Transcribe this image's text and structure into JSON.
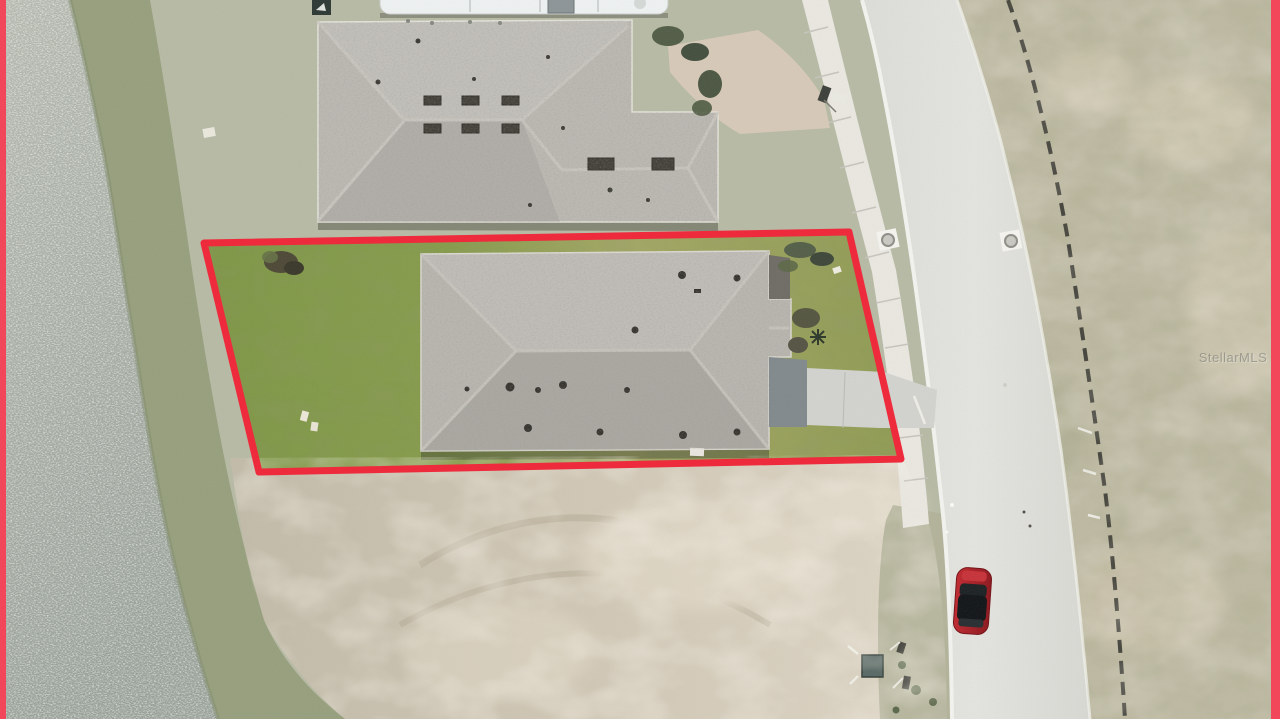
{
  "image": {
    "kind": "aerial-drone-photograph",
    "watermark": "StellarMLS"
  },
  "scene": {
    "water": "pond",
    "bank": "grassy shoreline bank",
    "neighbor_house": "neighboring house roof (top)",
    "rv": "white RV parked at top edge",
    "gravel_drive": "gravel driveway",
    "subject_lot": "red-outlined subject property",
    "subject_house": "subject house gray shingle roof",
    "driveway": "concrete driveway to street",
    "sidewalk": "concrete sidewalk",
    "road": "curved concrete street",
    "silt_fence": "construction silt fence",
    "vacant_lot": "graded dirt vacant lot",
    "car": "red car on road",
    "utility_box": "utility box",
    "manholes": "manhole covers at road edges",
    "mailbox": "mailbox"
  },
  "colors": {
    "boundary_red": "#ee2b3c",
    "edge_strip_red": "#f2475a",
    "water_top": "#b4b9af",
    "water_bottom": "#98a199",
    "bank_olive": "#97a07e",
    "lawn_green": "#7f9748",
    "lawn_yellow": "#a3a765",
    "roof_gray": "#b9b6b0",
    "neighbor_roof_gray": "#bcb9b3",
    "dirt_tan": "#cfc6b4",
    "dirt_light": "#ddd5c5",
    "road_gray": "#e3e3df",
    "sidewalk_gray": "#e9e7e0",
    "scrub_green": "#bdb9a2",
    "gravel_tan": "#d6c9b8",
    "fence_dark": "#3a3a34",
    "car_red": "#a81e25",
    "grass_base": "#b7baa5"
  }
}
